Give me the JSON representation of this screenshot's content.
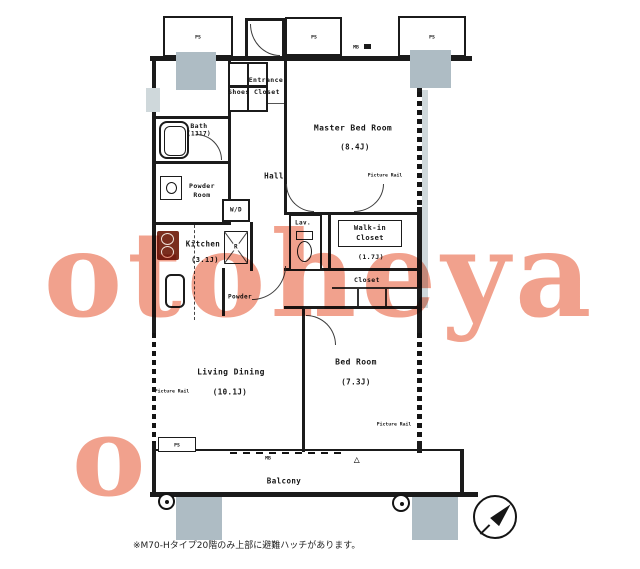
{
  "watermark": {
    "text": "otoheya",
    "fragment": "o"
  },
  "caption": "※M70-Hタイプ20階のみ上部に避難ハッチがあります。",
  "rooms": {
    "master_bed": {
      "name": "Master Bed Room",
      "size": "(8.4J)"
    },
    "living_dining": {
      "name": "Living Dining",
      "size": "(10.1J)"
    },
    "bed": {
      "name": "Bed Room",
      "size": "(7.3J)"
    },
    "kitchen": {
      "name": "Kitchen",
      "size": "(3.1J)"
    },
    "walk_in_closet": {
      "line1": "Walk-in",
      "line2": "Closet",
      "size": "(1.7J)"
    },
    "bath": {
      "name": "Bath",
      "size": "(1317)"
    },
    "powder_room": {
      "line1": "Powder",
      "line2": "Room"
    },
    "hall": {
      "name": "Hall"
    },
    "lav": {
      "name": "Lav."
    },
    "closet": {
      "name": "Closet"
    },
    "balcony": {
      "name": "Balcony"
    },
    "entrance": {
      "name": "Entrance"
    },
    "shoes_closet": {
      "name": "Shoes Closet"
    },
    "alcove": {
      "name": "Powder"
    }
  },
  "fixtures": {
    "washer_dryer": "W/D",
    "refrigerator": "R"
  },
  "service": {
    "pipe_shaft": "PS",
    "meter_box": "MB"
  },
  "window_label": "Picture Rail",
  "symbols": {
    "evacuation_hatch": "△"
  },
  "colors": {
    "watermark": "#ee8a70",
    "wall": "#1b1b1b",
    "column_gray": "#aebcc4"
  }
}
